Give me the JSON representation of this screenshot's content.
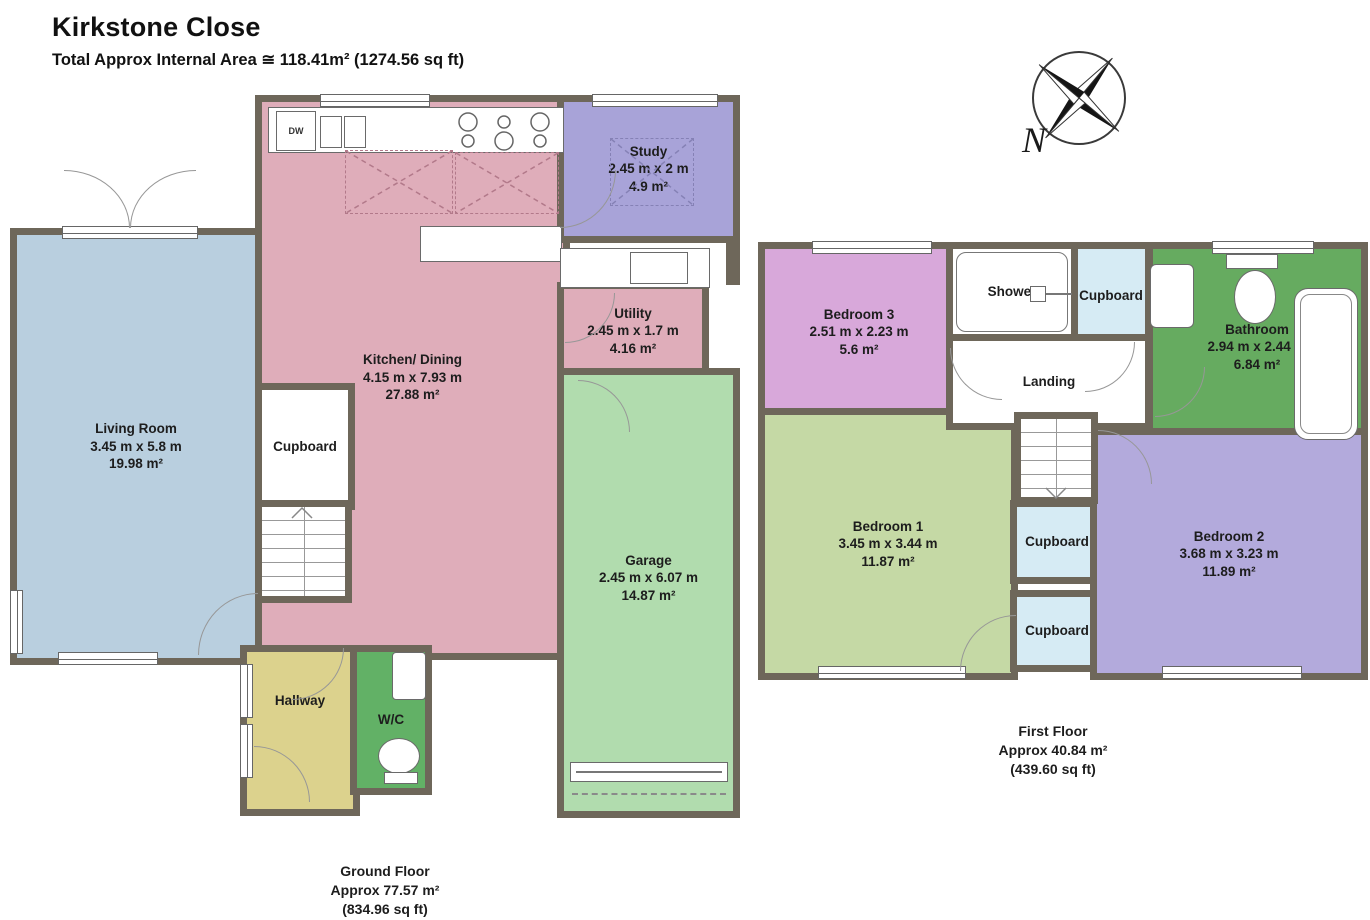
{
  "title": "Kirkstone Close",
  "subtitle": "Total Approx Internal Area ≅ 118.41m² (1274.56 sq ft)",
  "compass": {
    "north_label": "N"
  },
  "colors": {
    "wall": "#6e675a",
    "living_room": "#b9cfdf",
    "kitchen_dining": "#dfadba",
    "study": "#a8a3d8",
    "utility": "#dfadba",
    "garage": "#b1dcae",
    "hallway": "#dcd28d",
    "wc": "#62b166",
    "bedroom3": "#d8a8da",
    "bathroom": "#66ab60",
    "bedroom1": "#c5d9a5",
    "bedroom2": "#b3aadc",
    "cupboard_first_floor": "#d6ebf4"
  },
  "ground_floor": {
    "caption": {
      "name": "Ground Floor",
      "area": "Approx 77.57 m²",
      "sqft": "(834.96 sq ft)"
    },
    "rooms": {
      "living_room": {
        "name": "Living Room",
        "dims": "3.45 m x 5.8 m",
        "area": "19.98 m²"
      },
      "kitchen_dining": {
        "name": "Kitchen/ Dining",
        "dims": "4.15 m x 7.93 m",
        "area": "27.88 m²"
      },
      "study": {
        "name": "Study",
        "dims": "2.45 m x 2 m",
        "area": "4.9 m²"
      },
      "utility": {
        "name": "Utility",
        "dims": "2.45 m x 1.7 m",
        "area": "4.16 m²"
      },
      "garage": {
        "name": "Garage",
        "dims": "2.45 m x 6.07 m",
        "area": "14.87 m²"
      },
      "cupboard": {
        "name": "Cupboard"
      },
      "hallway": {
        "name": "Hallway"
      },
      "wc": {
        "name": "W/C"
      },
      "dishwasher": {
        "label": "DW"
      }
    }
  },
  "first_floor": {
    "caption": {
      "name": "First Floor",
      "area": "Approx 40.84 m²",
      "sqft": "(439.60 sq ft)"
    },
    "rooms": {
      "bedroom3": {
        "name": "Bedroom 3",
        "dims": "2.51 m x 2.23 m",
        "area": "5.6 m²"
      },
      "shower": {
        "name": "Shower"
      },
      "cupboard_top": {
        "name": "Cupboard"
      },
      "bathroom": {
        "name": "Bathroom",
        "dims": "2.94 m x 2.44 m",
        "area": "6.84 m²"
      },
      "landing": {
        "name": "Landing"
      },
      "bedroom1": {
        "name": "Bedroom 1",
        "dims": "3.45 m x 3.44 m",
        "area": "11.87 m²"
      },
      "cupboard_mid": {
        "name": "Cupboard"
      },
      "cupboard_bottom": {
        "name": "Cupboard"
      },
      "bedroom2": {
        "name": "Bedroom 2",
        "dims": "3.68 m x 3.23 m",
        "area": "11.89 m²"
      }
    }
  }
}
